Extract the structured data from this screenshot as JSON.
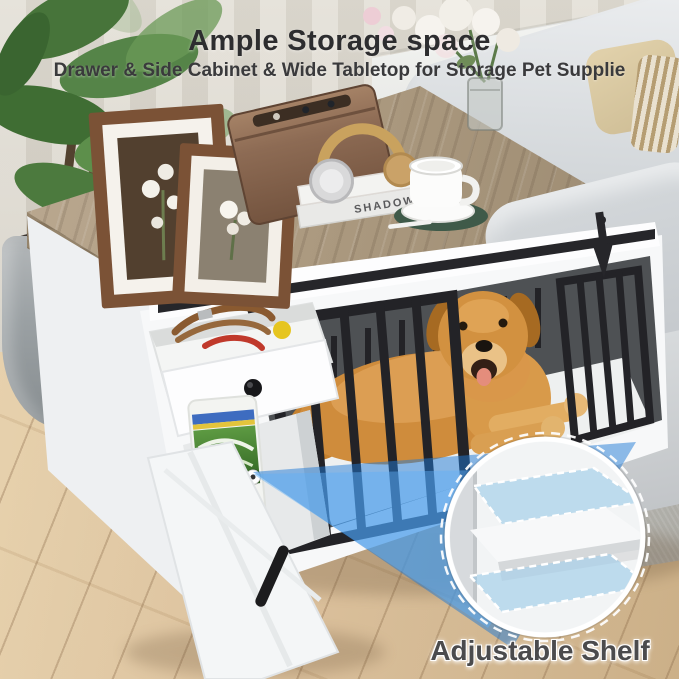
{
  "header": {
    "title": "Ample Storage space",
    "subtitle": "Drawer & Side Cabinet & Wide Tabletop for Storage Pet Supplie"
  },
  "callout": {
    "label": "Adjustable Shelf"
  },
  "props": {
    "book_spine_text": "SHADOW"
  },
  "palette": {
    "title_text": "#2d2d2f",
    "caption_text": "#4b4b4d",
    "beam_blue": "#2f87d8",
    "shelf_highlight_blue": "#9dcbe9",
    "tabletop_wood": "#ab997f",
    "floor_wood": "#d9bd97",
    "cabinet_white": "#f7f8f9",
    "crate_bars": "#232327",
    "dog_golden": "#d2923f",
    "coaster_green": "#3f5a49",
    "food_bag_label_green": "#4c8a38"
  },
  "icons": {
    "callout_dot": "white circular marker dot",
    "drawer_knob": "round black knob"
  }
}
